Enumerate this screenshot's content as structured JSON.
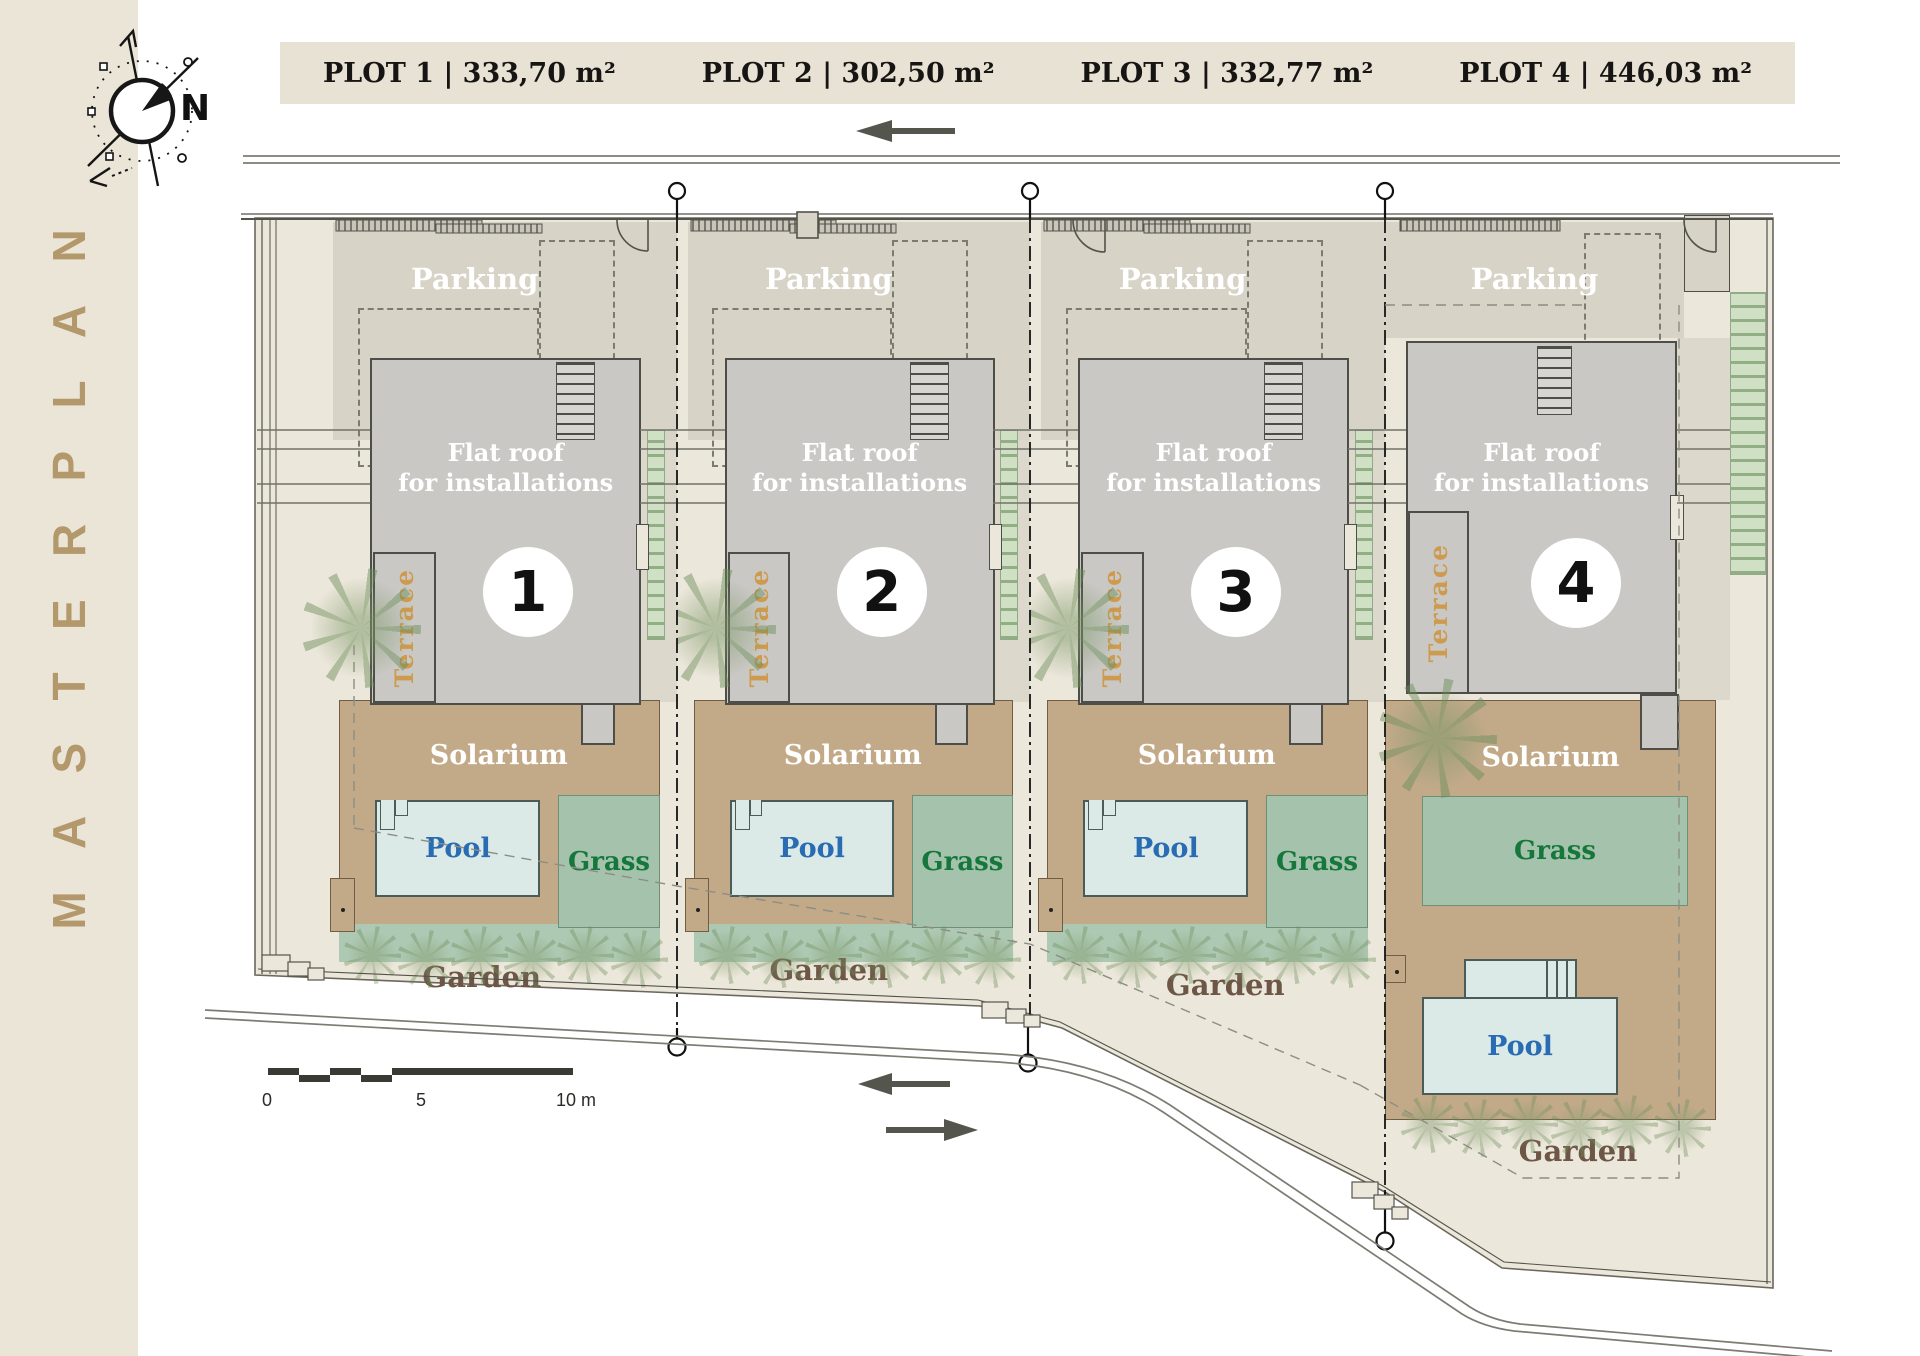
{
  "masterplan": {
    "title": "MASTERPLAN"
  },
  "compass": {
    "label": "N"
  },
  "plots": [
    {
      "number": "1",
      "header": "PLOT 1 | 333,70 m²"
    },
    {
      "number": "2",
      "header": "PLOT 2 | 302,50 m²"
    },
    {
      "number": "3",
      "header": "PLOT 3 | 332,77 m²"
    },
    {
      "number": "4",
      "header": "PLOT 4 | 446,03 m²"
    }
  ],
  "unit_labels": {
    "parking": "Parking",
    "flat_roof_line1": "Flat roof",
    "flat_roof_line2": "for installations",
    "terrace": "Terrace",
    "solarium": "Solarium",
    "pool": "Pool",
    "grass": "Grass",
    "garden": "Garden"
  },
  "scale_bar": {
    "zero": "0",
    "five": "5",
    "ten": "10 m"
  },
  "colors": {
    "sidebar_bg": "#ebe5d8",
    "sidebar_text": "#b3986b",
    "header_bg": "#e8e2d5",
    "site_bg": "#ece7db",
    "parking": "#d7d3c7",
    "building": "#c9c8c4",
    "building_outline": "#4e4e48",
    "solarium": "#c2aa89",
    "pool": "#dbeae6",
    "pool_text": "#2a6cb3",
    "grass": "#a5c3ac",
    "grass_text": "#15773c",
    "garden_text": "#6d5646",
    "terrace_text": "#cd9a4e",
    "hedge": "#cfe0c5",
    "road_line": "#7c7c73",
    "arrow": "#54554d"
  }
}
